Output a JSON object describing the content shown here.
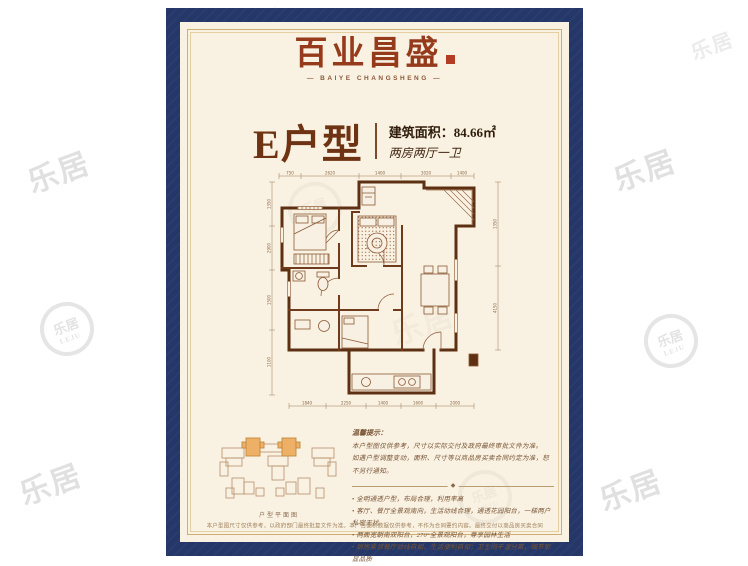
{
  "colors": {
    "panel_navy": "#253768",
    "paper_cream": "#f9f1e2",
    "frame_gold": "#cfae74",
    "brand_red": "#963a1c",
    "title_brown": "#6e3312",
    "plan_wall": "#5d2f13",
    "site_highlight": "#eeb066",
    "watermark_gray": "#c7c7c7"
  },
  "logo": {
    "brand_cn": "百业昌盛",
    "brand_en": "— BAIYE CHANGSHENG —"
  },
  "header": {
    "unit_label": "E户型",
    "area_label": "建筑面积：84.66㎡",
    "layout_label": "两房两厅一卫"
  },
  "floorplan": {
    "dims_top": [
      "750",
      "2620",
      "1400",
      "3020",
      "1400"
    ],
    "dims_bottom": [
      "1840",
      "2250",
      "1400",
      "1600",
      "2000"
    ],
    "dims_left": [
      "1350",
      "2900",
      "1500",
      "1100"
    ],
    "dims_right": [
      "1350",
      "4150"
    ]
  },
  "siteplan": {
    "caption": "户型平面图"
  },
  "notes": {
    "title": "温馨提示：",
    "intro": [
      "本户型图仅供参考，尺寸以实际交付及政府最终审批文件为准。",
      "如遇户型调整变动，面积、尺寸等以商品房买卖合同约定为准，恕不另行通知。"
    ],
    "divider_glyph": "◆",
    "bullets": [
      "全明通透户型，布局合理，利用率高",
      "客厅、餐厅全景观南向，生活动线合理，通透花园阳台，一梯两户私密无扰",
      "两面宽朝南双阳台，270°全景观阳台，尊享园林生活",
      "厨房紧邻餐厅动线自如，生活便利自如；卫生间干湿分离，细节彰显品质"
    ]
  },
  "footer": {
    "disclaimer": "本户型图尺寸仅供参考，以政府部门最终批复文件为准。本广告面积数据仅供参考，不作为合同要约内容。最终交付以商品房买卖合同及附件约定为准，开发商享有最终解释权。"
  },
  "watermark": {
    "text": "乐居",
    "logo_text": "乐居",
    "logo_caption": "LEJU"
  }
}
